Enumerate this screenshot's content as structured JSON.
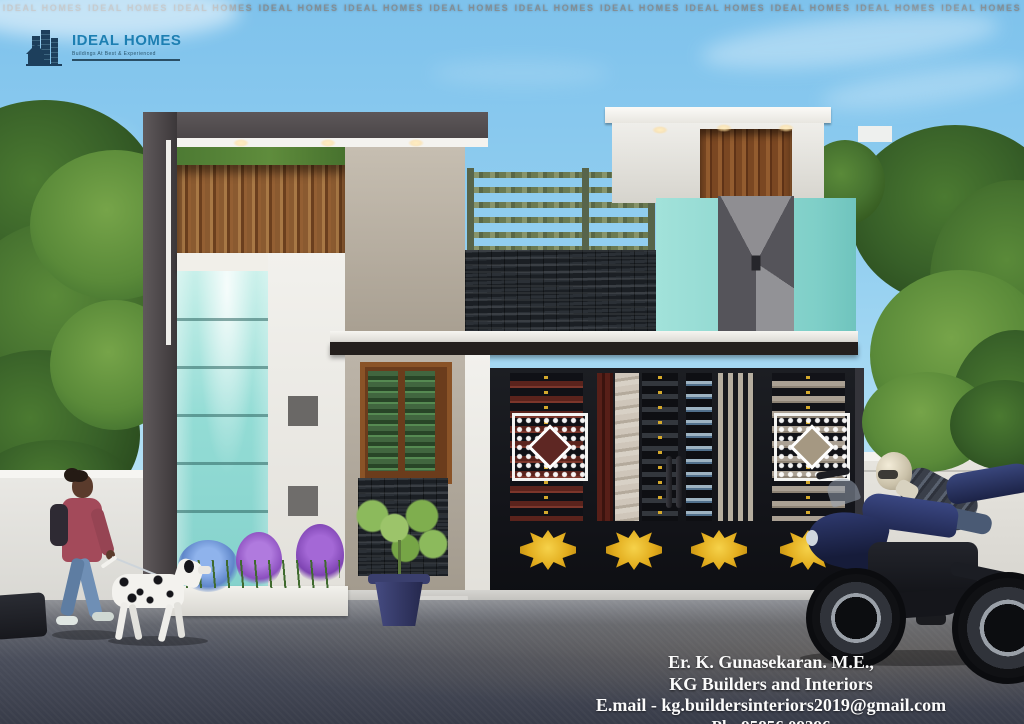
{
  "meta": {
    "scene": "3D exterior elevation render of a modern single-storey house with compound gate, pedestrian walking a dalmatian, and a parked sport motorcycle with rider",
    "canvas": {
      "width": 1024,
      "height": 724
    }
  },
  "branding": {
    "logo_text": "IDEAL HOMES",
    "logo_tagline": "Buildings At Best & Experienced",
    "logo_text_color": "#1d7fb2",
    "logo_icon": "buildings-and-house-icon",
    "logo_icon_color": "#1d3f5c"
  },
  "watermark": {
    "text": "IDEAL HOMES",
    "repeat": 12,
    "color": "#878787"
  },
  "contact": {
    "line1": "Er. K.  Gunasekaran. M.E.,",
    "line2": "KG Builders and Interiors",
    "line3": "E.mail - kg.buildersinteriors2019@gmail.com",
    "line4": "Ph: 95856 09396"
  },
  "palette": {
    "sky": "#93cff0",
    "teal_glass": "#93dcd5",
    "teal_wall": "#8fd8d1",
    "wood": "#8a5a30",
    "dark_frame": "#56504f",
    "stone": "#22262b",
    "gate_black": "#17191d",
    "gold_ornament": "#e2ac1d",
    "road": "#4a4e5b",
    "white_wall": "#f2f1ed",
    "jacket_maroon": "#a34a5a",
    "motorcycle_navy": "#2b3560",
    "foliage": "#477330"
  },
  "scene_objects": [
    "left-pylon-with-dark-frame",
    "wood-slat-band",
    "teal-glass-tower",
    "flower-planter",
    "center-column-window-green-louvers",
    "slate-stone-panels",
    "porch-canopy",
    "terrace-railing-with-plants",
    "stair-headroom",
    "teal-block-upper-door",
    "black-compound-gate",
    "white-lattice-ornaments",
    "gold-gate-ornaments",
    "potted-plant",
    "compound-walls",
    "woman-walking",
    "dalmatian-dog",
    "sport-motorcycle",
    "motorcycle-rider",
    "left-tree",
    "right-tree",
    "road"
  ]
}
